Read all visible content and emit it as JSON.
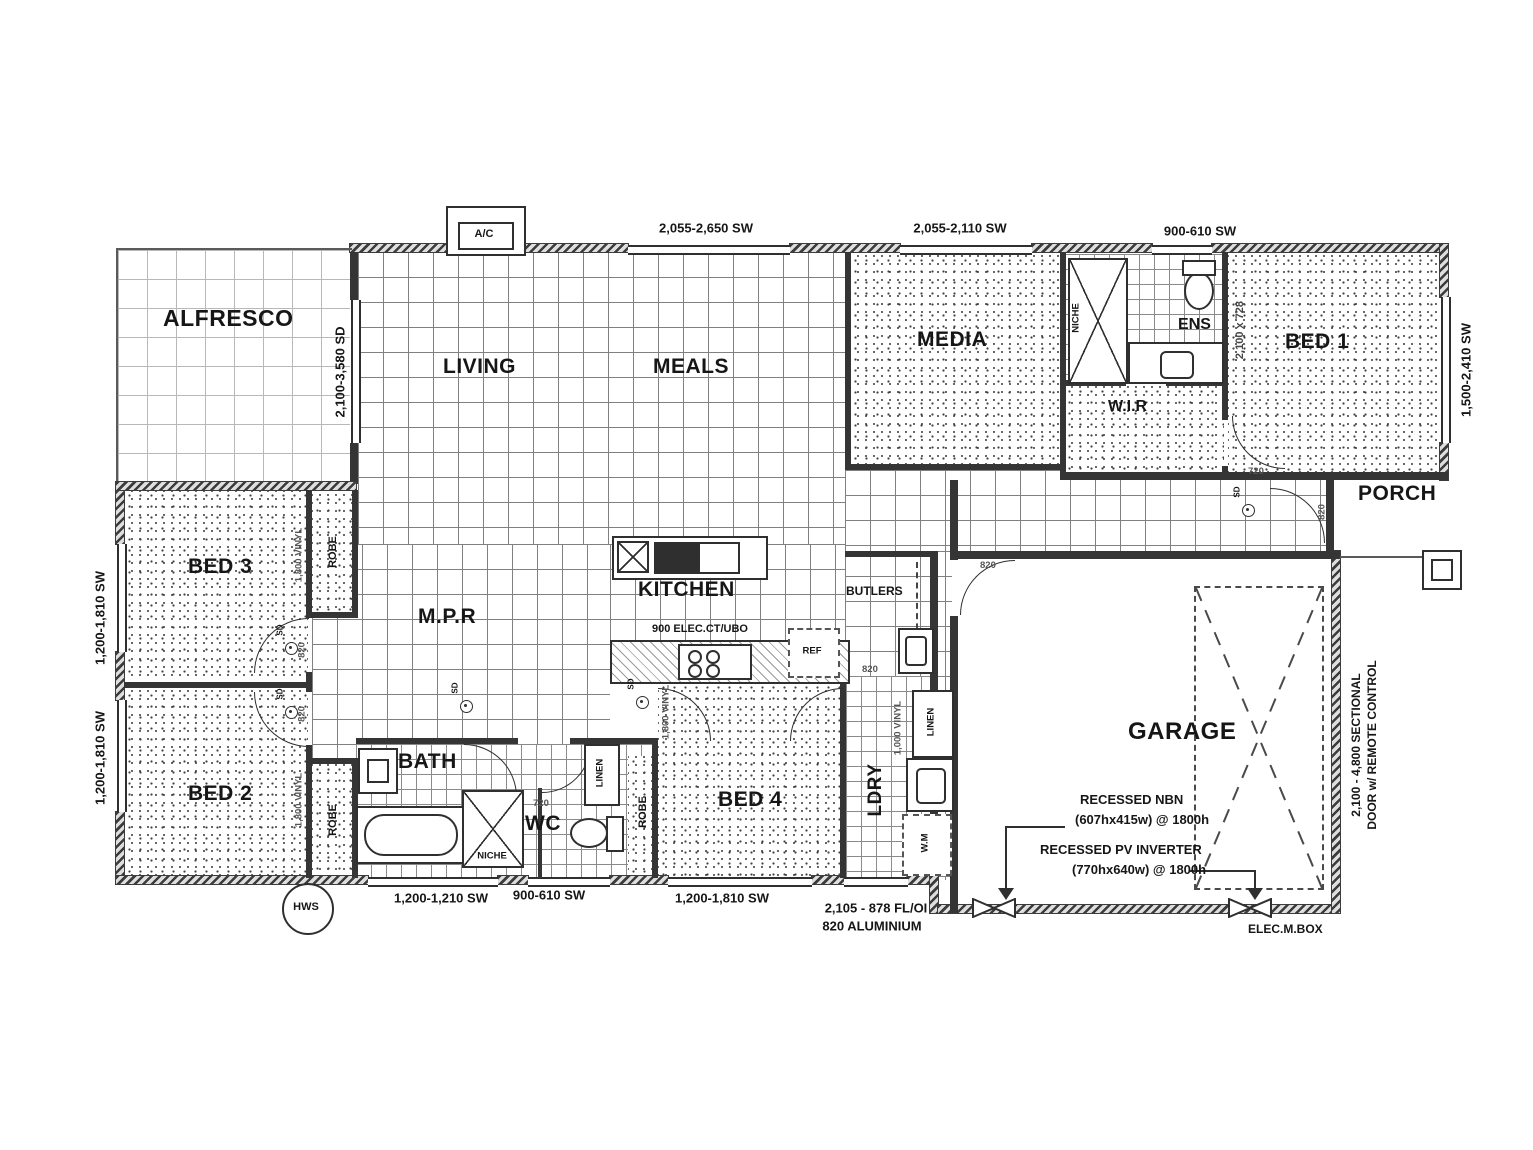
{
  "rooms": {
    "alfresco": "ALFRESCO",
    "living": "LIVING",
    "meals": "MEALS",
    "media": "MEDIA",
    "ens": "ENS",
    "bed1": "BED 1",
    "wir": "W.I.R",
    "porch": "PORCH",
    "bed3": "BED 3",
    "mpr": "M.P.R",
    "kitchen": "KITCHEN",
    "butlers": "BUTLERS",
    "bed2": "BED 2",
    "bath": "BATH",
    "wc": "WC",
    "bed4": "BED 4",
    "ldry": "LDRY",
    "garage": "GARAGE"
  },
  "dims": {
    "top_living": "2,055-2,650 SW",
    "top_media": "2,055-2,110 SW",
    "top_ens": "900-610 SW",
    "right_bed1": "1,500-2,410 SW",
    "alfresco_sd": "2,100-3,580 SD",
    "left_bed3": "1,200-1,810 SW",
    "left_bed2": "1,200-1,810 SW",
    "bottom_bath": "1,200-1,210 SW",
    "bottom_wc": "900-610 SW",
    "bottom_bed4": "1,200-1,810 SW",
    "ldry_door_1": "2,105 - 878 FL/OI",
    "ldry_door_2": "820 ALUMINIUM",
    "ens_panel": "2,100 x 728",
    "kitchen_bench": "900 ELEC.CT/UBO",
    "hall_vinyl": "1,000 VINYL",
    "robe_vinyl": "1,800 VINYL",
    "garage_door_1": "2,100 - 4,800 SECTIONAL",
    "garage_door_2": "DOOR w/ REMOTE CONTROL",
    "d720": "720",
    "d820": "820"
  },
  "storage": {
    "robe": "ROBE",
    "linen": "LINEN",
    "niche": "NICHE"
  },
  "symbols": {
    "ac": "A/C",
    "hws": "HWS",
    "ref": "REF",
    "wm": "W.M",
    "sd": "SD",
    "elec": "ELEC.M.BOX"
  },
  "annotations": {
    "nbn_1": "RECESSED NBN",
    "nbn_2": "(607hx415w) @ 1800h",
    "pv_1": "RECESSED PV INVERTER",
    "pv_2": "(770hx640w) @ 1800h"
  }
}
